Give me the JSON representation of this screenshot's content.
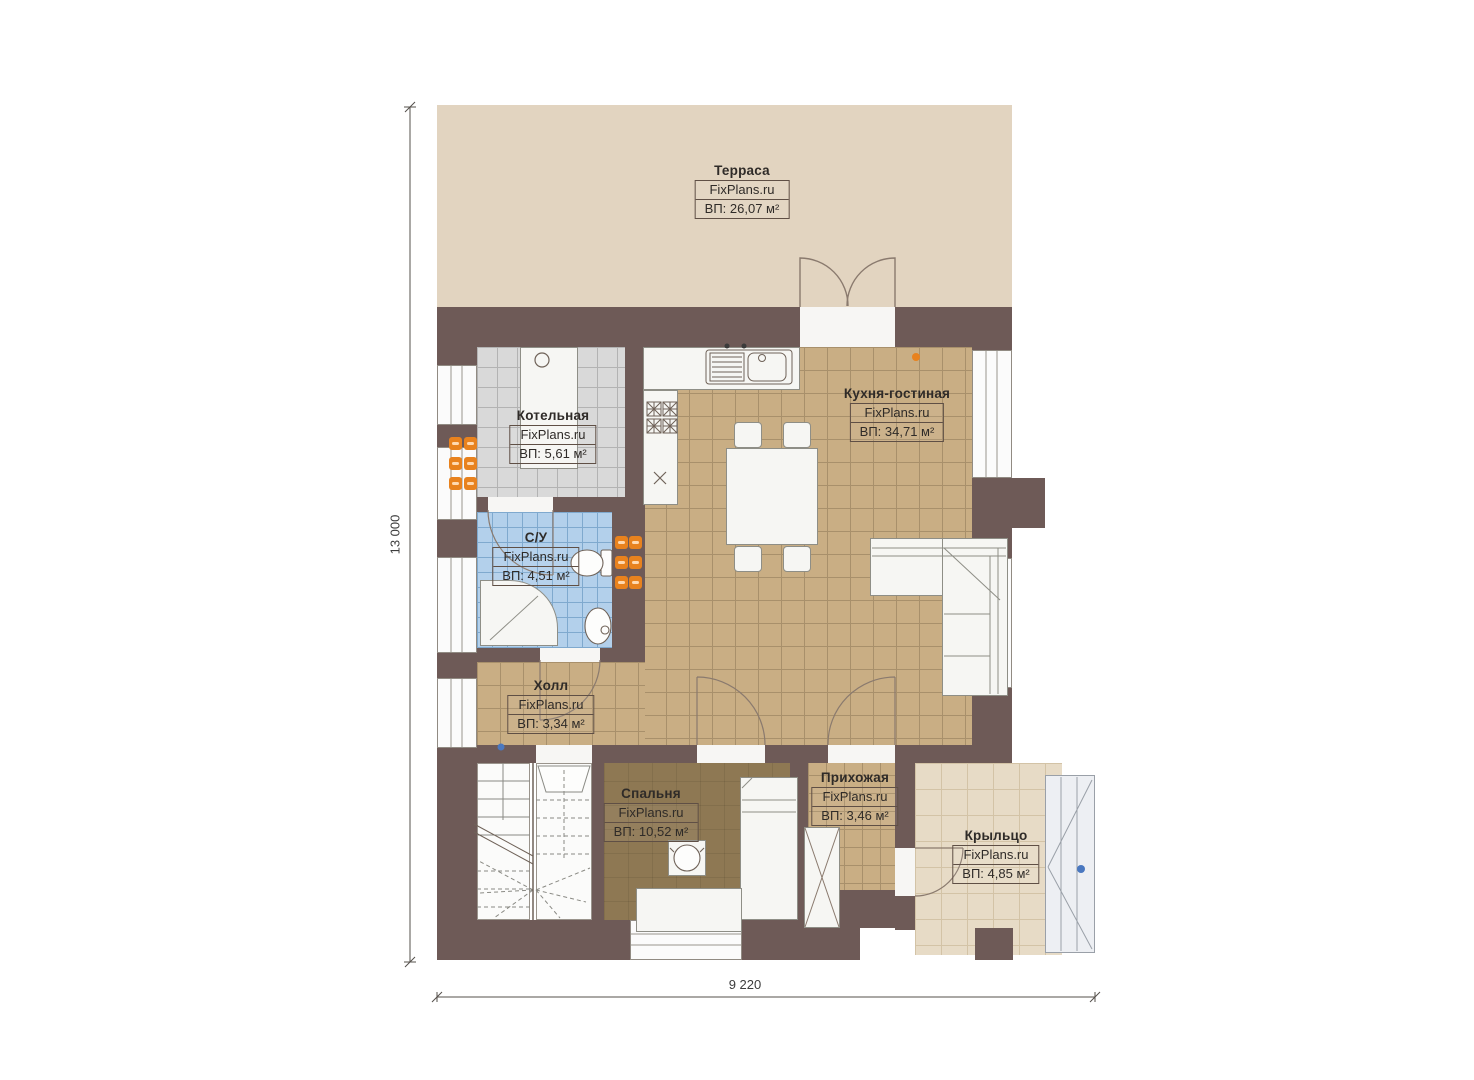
{
  "watermark": "FixPlans.ru",
  "rooms": [
    {
      "name": "Терраса",
      "area": "ВП: 26,07 м²"
    },
    {
      "name": "Котельная",
      "area": "ВП: 5,61 м²"
    },
    {
      "name": "Кухня-гостиная",
      "area": "ВП: 34,71 м²"
    },
    {
      "name": "С/У",
      "area": "ВП: 4,51 м²"
    },
    {
      "name": "Холл",
      "area": "ВП: 3,34 м²"
    },
    {
      "name": "Спальня",
      "area": "ВП: 10,52 м²"
    },
    {
      "name": "Прихожая",
      "area": "ВП: 3,46 м²"
    },
    {
      "name": "Крыльцо",
      "area": "ВП: 4,85 м²"
    }
  ],
  "dimensions": {
    "vertical": "13 000",
    "horizontal": "9 220"
  },
  "colors": {
    "wall": "#6e5a57",
    "terrace": "#e2d4c0",
    "kitchen_tile": "#c9ae84",
    "boiler_tile": "#d9d9d9",
    "bathroom_tile": "#b3d0eb",
    "bedroom_floor": "#8e7853",
    "porch": "#e7dbc6",
    "radiator": "#e8821e",
    "marker_dot": "#4a78c0"
  }
}
